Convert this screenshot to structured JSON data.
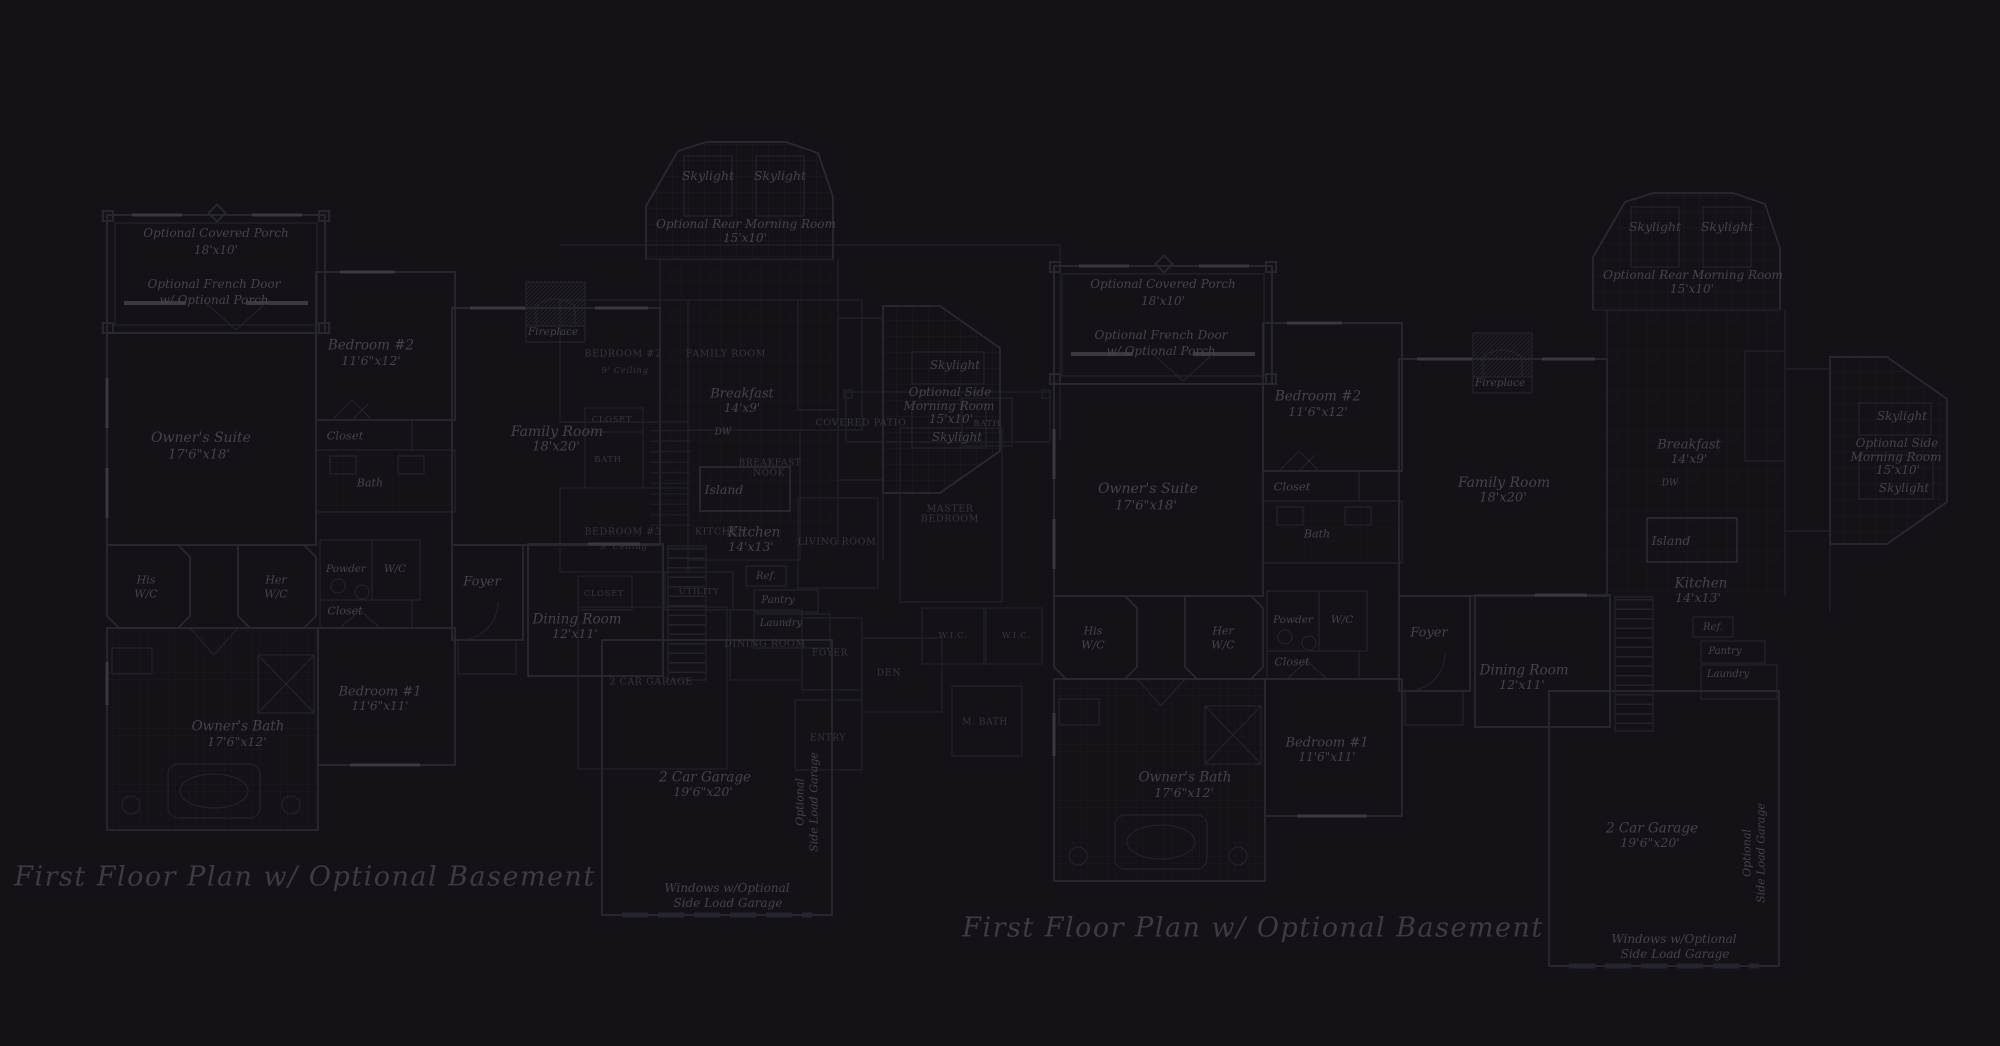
{
  "colors": {
    "background": "#141216",
    "wall": "#2b2930",
    "wall_dim": "#262430",
    "window_mark": "#3a3840",
    "tile_grid": "#1e1c23",
    "label_ink": "#46434c",
    "caps_label_ink": "#37353e",
    "title_ink": "#3e3b44"
  },
  "titles": [
    {
      "text": "First Floor Plan  w/ Optional Basement"
    },
    {
      "text": "First Floor Plan  w/ Optional Basement"
    }
  ],
  "italic_plan": {
    "instances": [
      {
        "id": "left",
        "dx": 0,
        "dy": 0
      },
      {
        "id": "right",
        "dx": 947,
        "dy": 51
      }
    ],
    "labels": [
      {
        "t": "Optional Covered Porch",
        "x": 216,
        "y": 233,
        "fs": 12
      },
      {
        "t": "18'x10'",
        "x": 216,
        "y": 250,
        "fs": 12
      },
      {
        "t": "Optional French Door",
        "x": 214,
        "y": 284,
        "fs": 12
      },
      {
        "t": "w/ Optional Porch",
        "x": 214,
        "y": 300,
        "fs": 12
      },
      {
        "t": "Bedroom #2",
        "x": 371,
        "y": 346,
        "fs": 13.5
      },
      {
        "t": "11'6\"x12'",
        "x": 371,
        "y": 361,
        "fs": 12.5
      },
      {
        "t": "Closet",
        "x": 345,
        "y": 436,
        "fs": 11.5
      },
      {
        "t": "Bath",
        "x": 370,
        "y": 483,
        "fs": 11
      },
      {
        "t": "Owner's Suite",
        "x": 201,
        "y": 438,
        "fs": 14
      },
      {
        "t": "17'6\"x18'",
        "x": 199,
        "y": 455,
        "fs": 13
      },
      {
        "t": "His",
        "x": 146,
        "y": 580,
        "fs": 11
      },
      {
        "t": "W/C",
        "x": 146,
        "y": 594,
        "fs": 11
      },
      {
        "t": "Her",
        "x": 276,
        "y": 580,
        "fs": 11
      },
      {
        "t": "W/C",
        "x": 276,
        "y": 594,
        "fs": 11
      },
      {
        "t": "Powder",
        "x": 346,
        "y": 569,
        "fs": 10.5
      },
      {
        "t": "W/C",
        "x": 395,
        "y": 569,
        "fs": 10.5
      },
      {
        "t": "Closet",
        "x": 345,
        "y": 611,
        "fs": 11
      },
      {
        "t": "Owner's Bath",
        "x": 238,
        "y": 727,
        "fs": 13.5
      },
      {
        "t": "17'6\"x12'",
        "x": 237,
        "y": 742,
        "fs": 12.5
      },
      {
        "t": "Bedroom #1",
        "x": 380,
        "y": 692,
        "fs": 13
      },
      {
        "t": "11'6\"x11'",
        "x": 380,
        "y": 706,
        "fs": 12
      },
      {
        "t": "Foyer",
        "x": 482,
        "y": 582,
        "fs": 13
      },
      {
        "t": "Dining Room",
        "x": 577,
        "y": 620,
        "fs": 13.5
      },
      {
        "t": "12'x11'",
        "x": 575,
        "y": 634,
        "fs": 12.5
      },
      {
        "t": "Family Room",
        "x": 557,
        "y": 432,
        "fs": 14
      },
      {
        "t": "18'x20'",
        "x": 556,
        "y": 447,
        "fs": 13
      },
      {
        "t": "Fireplace",
        "x": 553,
        "y": 332,
        "fs": 10.5
      },
      {
        "t": "Skylight",
        "x": 708,
        "y": 176,
        "fs": 12.5
      },
      {
        "t": "Skylight",
        "x": 780,
        "y": 176,
        "fs": 12.5
      },
      {
        "t": "Optional Rear Morning Room",
        "x": 746,
        "y": 224,
        "fs": 12
      },
      {
        "t": "15'x10'",
        "x": 745,
        "y": 238,
        "fs": 12
      },
      {
        "t": "Breakfast",
        "x": 742,
        "y": 394,
        "fs": 13
      },
      {
        "t": "14'x9'",
        "x": 742,
        "y": 408,
        "fs": 12
      },
      {
        "t": "DW",
        "x": 723,
        "y": 433,
        "fs": 9
      },
      {
        "t": "Island",
        "x": 724,
        "y": 490,
        "fs": 12.5
      },
      {
        "t": "Kitchen",
        "x": 754,
        "y": 533,
        "fs": 13.5
      },
      {
        "t": "14'x13'",
        "x": 751,
        "y": 547,
        "fs": 12.5
      },
      {
        "t": "Ref.",
        "x": 766,
        "y": 577,
        "fs": 10
      },
      {
        "t": "Pantry",
        "x": 778,
        "y": 601,
        "fs": 10
      },
      {
        "t": "Laundry",
        "x": 781,
        "y": 624,
        "fs": 10
      },
      {
        "t": "2 Car Garage",
        "x": 705,
        "y": 778,
        "fs": 13.5
      },
      {
        "t": "19'6\"x20'",
        "x": 703,
        "y": 792,
        "fs": 12.5
      },
      {
        "t": "Windows w/Optional",
        "x": 727,
        "y": 888,
        "fs": 12
      },
      {
        "t": "Side Load Garage",
        "x": 728,
        "y": 903,
        "fs": 12
      },
      {
        "t": "Optional",
        "x": 800,
        "y": 802,
        "fs": 11,
        "rot": 1
      },
      {
        "t": "Side Load Garage",
        "x": 814,
        "y": 802,
        "fs": 11,
        "rot": 1
      },
      {
        "t": "Skylight",
        "x": 955,
        "y": 365,
        "fs": 12
      },
      {
        "t": "Optional Side",
        "x": 950,
        "y": 392,
        "fs": 12
      },
      {
        "t": "Morning Room",
        "x": 949,
        "y": 406,
        "fs": 12
      },
      {
        "t": "15'x10'",
        "x": 951,
        "y": 419,
        "fs": 12
      },
      {
        "t": "Skylight",
        "x": 957,
        "y": 437,
        "fs": 12
      }
    ]
  },
  "caps_plan": {
    "labels": [
      {
        "t": "BEDROOM #2",
        "x": 623,
        "y": 354
      },
      {
        "t": "9' Ceiling",
        "x": 625,
        "y": 371,
        "fs": 8.5,
        "it": 1
      },
      {
        "t": "FAMILY ROOM",
        "x": 726,
        "y": 354
      },
      {
        "t": "CLOSET",
        "x": 612,
        "y": 420,
        "fs": 8.5
      },
      {
        "t": "BATH",
        "x": 608,
        "y": 460,
        "fs": 8.5
      },
      {
        "t": "BEDROOM #3",
        "x": 623,
        "y": 532
      },
      {
        "t": "9' Ceiling",
        "x": 624,
        "y": 547,
        "fs": 8.5,
        "it": 1
      },
      {
        "t": "BREAKFAST",
        "x": 770,
        "y": 464,
        "fs": 9
      },
      {
        "t": "NOOK",
        "x": 769,
        "y": 474,
        "fs": 9
      },
      {
        "t": "KITCHEN",
        "x": 721,
        "y": 532
      },
      {
        "t": "UTILITY",
        "x": 699,
        "y": 592,
        "fs": 8.5
      },
      {
        "t": "CLOSET",
        "x": 604,
        "y": 594,
        "fs": 8.5
      },
      {
        "t": "2 CAR GARAGE",
        "x": 651,
        "y": 682
      },
      {
        "t": "DINING ROOM",
        "x": 765,
        "y": 644
      },
      {
        "t": "FOYER",
        "x": 830,
        "y": 654,
        "fs": 9
      },
      {
        "t": "ENTRY",
        "x": 828,
        "y": 739,
        "fs": 9
      },
      {
        "t": "DEN",
        "x": 889,
        "y": 673,
        "fs": 9.5
      },
      {
        "t": "MASTER",
        "x": 950,
        "y": 509
      },
      {
        "t": "BEDROOM",
        "x": 950,
        "y": 519
      },
      {
        "t": "LIVING ROOM",
        "x": 837,
        "y": 542
      },
      {
        "t": "COVERED PATIO",
        "x": 861,
        "y": 423
      },
      {
        "t": "BATH",
        "x": 987,
        "y": 424,
        "fs": 8.5
      },
      {
        "t": "W.I.C.",
        "x": 953,
        "y": 636,
        "fs": 8.5
      },
      {
        "t": "W.I.C.",
        "x": 1016,
        "y": 636,
        "fs": 8.5
      },
      {
        "t": "M. BATH",
        "x": 985,
        "y": 723,
        "fs": 9
      }
    ]
  }
}
